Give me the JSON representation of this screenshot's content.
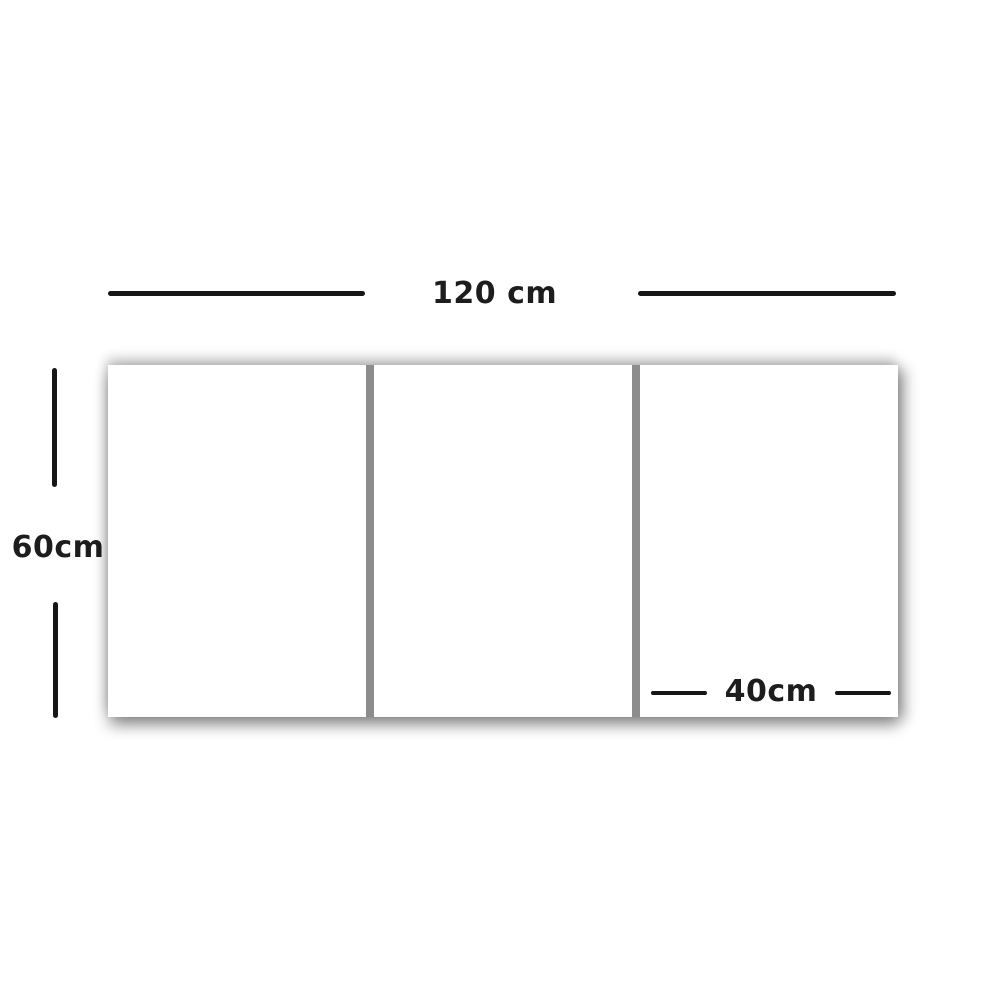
{
  "diagram": {
    "kind": "product-dimension-diagram",
    "subject": "three-panel canvas set (triptych)",
    "labels": {
      "total_width": "120 cm",
      "height": "60cm",
      "panel_width": "40cm"
    },
    "panels": {
      "count": 3,
      "fill": "#ffffff",
      "divider_color": "#8c8c8c"
    },
    "colors": {
      "background": "#ffffff",
      "dimension_line": "#161616",
      "label_text": "#1d1d1d",
      "shadow": "rgba(0,0,0,0.3)"
    }
  }
}
